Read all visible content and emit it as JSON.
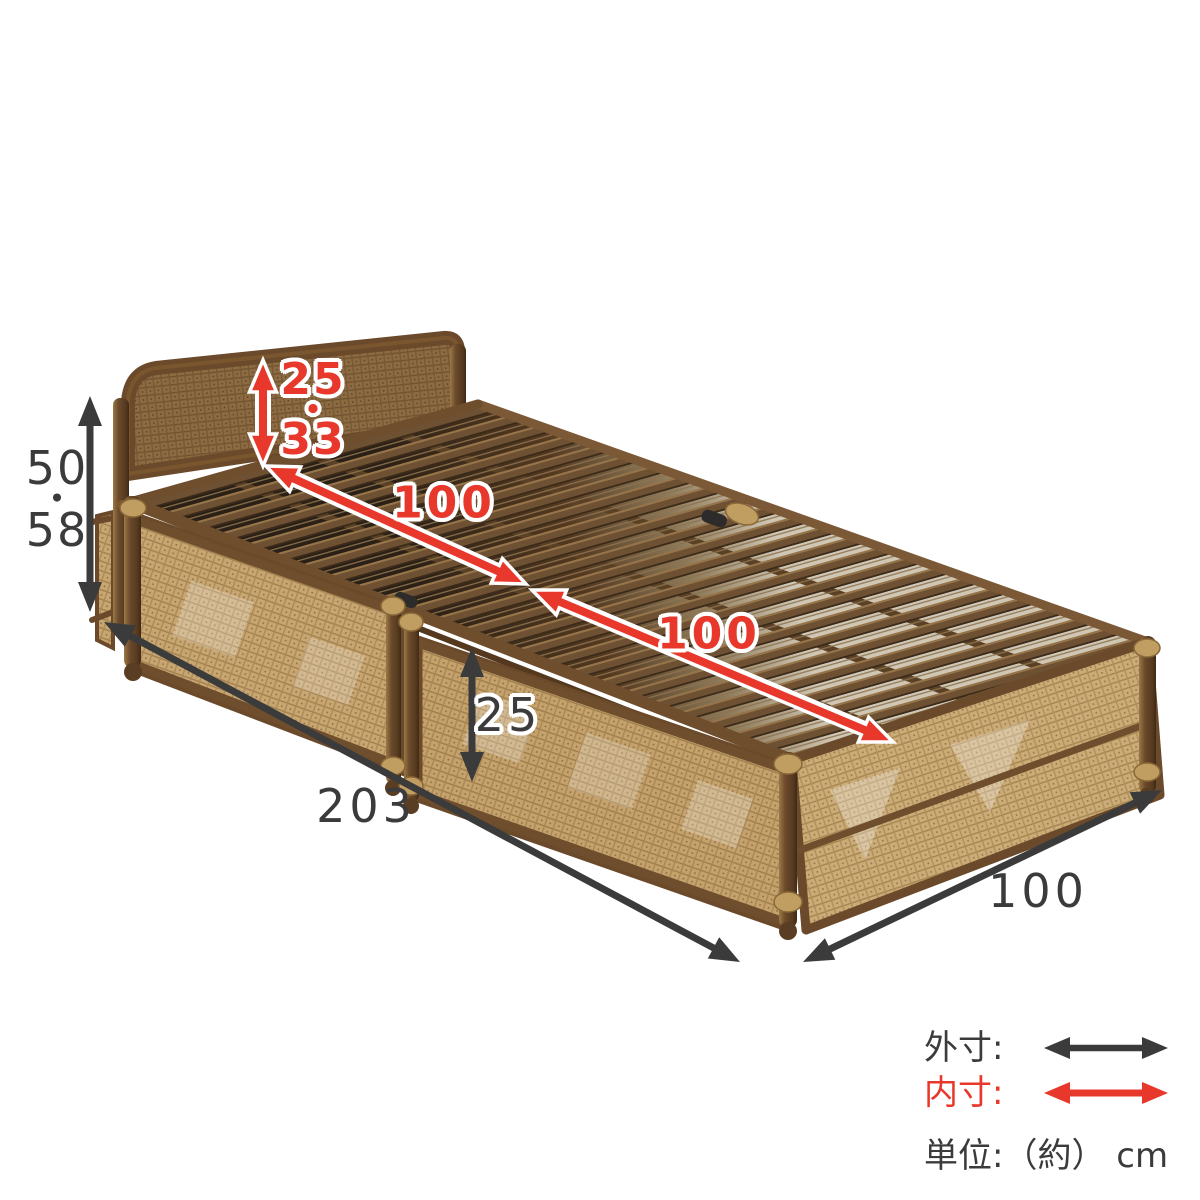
{
  "canvas": {
    "width": 1200,
    "height": 1200,
    "background": "#ffffff"
  },
  "dimensions": {
    "overall_height": {
      "value_top": "50",
      "separator": "・",
      "value_bottom": "58"
    },
    "headboard_height": {
      "value_top": "25",
      "separator": "・",
      "value_bottom": "33"
    },
    "inner_length_head": "100",
    "inner_length_foot": "100",
    "side_frame_height": "25",
    "overall_length": "203",
    "overall_width": "100"
  },
  "legend": {
    "outer_label": "外寸:",
    "inner_label": "内寸:",
    "unit_label": "単位:（約） cm",
    "outer_arrow_color": "#3b3b3b",
    "inner_arrow_color": "#e8372b"
  }
}
